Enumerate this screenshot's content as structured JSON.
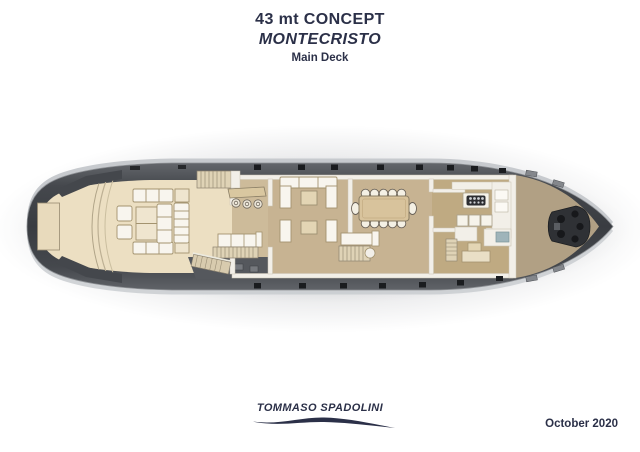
{
  "header": {
    "title": "43 mt CONCEPT",
    "model_name": "MONTECRISTO",
    "deck_label": "Main Deck"
  },
  "footer": {
    "designer_logo": "TOMMASO SPADOLINI",
    "date": "October 2020"
  },
  "colors": {
    "text_navy": "#2b3048",
    "hull_dark": "#3f4247",
    "aft_deck_cream": "#ecdfc2",
    "interior_floor_tan": "#c7b392",
    "bow_deck_tan": "#b1a084",
    "furniture_white": "#f8f5ee",
    "wood_tan": "#d8c39c"
  }
}
